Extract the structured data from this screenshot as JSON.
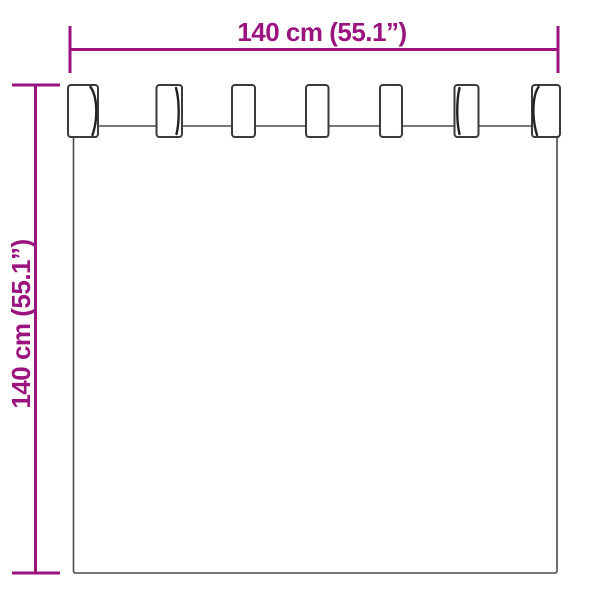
{
  "image": {
    "background_color": "#FFFFFF",
    "subject": "Tab-top curtain dimension diagram"
  },
  "dimensions": {
    "width": {
      "label": "140 cm (55.1”)"
    },
    "height": {
      "label": "140 cm (55.1”)"
    }
  },
  "curtain": {
    "tab_count": 7
  },
  "colors": {
    "dimension_annotation": "#9A137F",
    "drawing_outline": "#3F3F3F"
  }
}
